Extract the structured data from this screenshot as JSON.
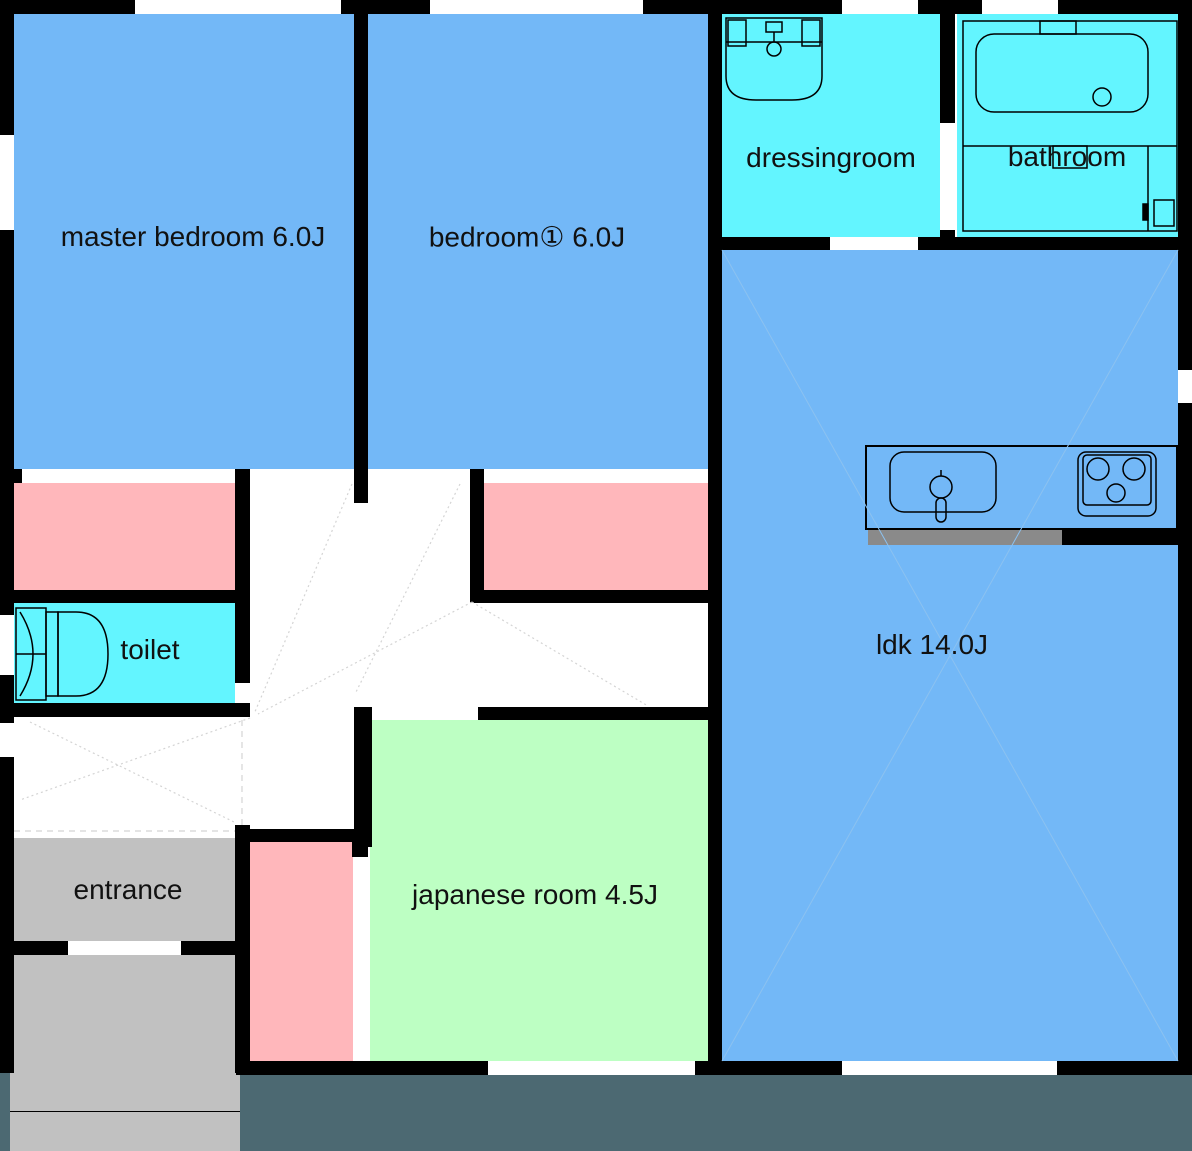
{
  "title": "apartment floor plan",
  "colors": {
    "room_blue": "#73B8F7",
    "wet_cyan": "#63F5FF",
    "closet_pink": "#FFB7BB",
    "tatami_green": "#BDFFC3",
    "entrance_gray": "#C1C1C1",
    "balcony_slate": "#4C6972",
    "wall_black": "#000000",
    "counter_gray": "#8A8A8A",
    "swing_line": "#D4D4D4",
    "ldk_diag": "#8CC2F0"
  },
  "rooms": {
    "master_bedroom": {
      "label": "master bedroom 6.0J"
    },
    "bedroom1": {
      "label": "bedroom① 6.0J"
    },
    "dressingroom": {
      "label": "dressingroom"
    },
    "bathroom": {
      "label": "bathroom"
    },
    "toilet": {
      "label": "toilet"
    },
    "entrance": {
      "label": "entrance"
    },
    "japanese_room": {
      "label": "japanese room 4.5J"
    },
    "ldk": {
      "label": "ldk 14.0J"
    }
  },
  "fixtures": {
    "washbasin": "washbasin",
    "bathtub": "bathtub",
    "toilet_bowl": "toilet bowl",
    "kitchen_sink": "kitchen sink",
    "stove": "3-burner stove"
  }
}
